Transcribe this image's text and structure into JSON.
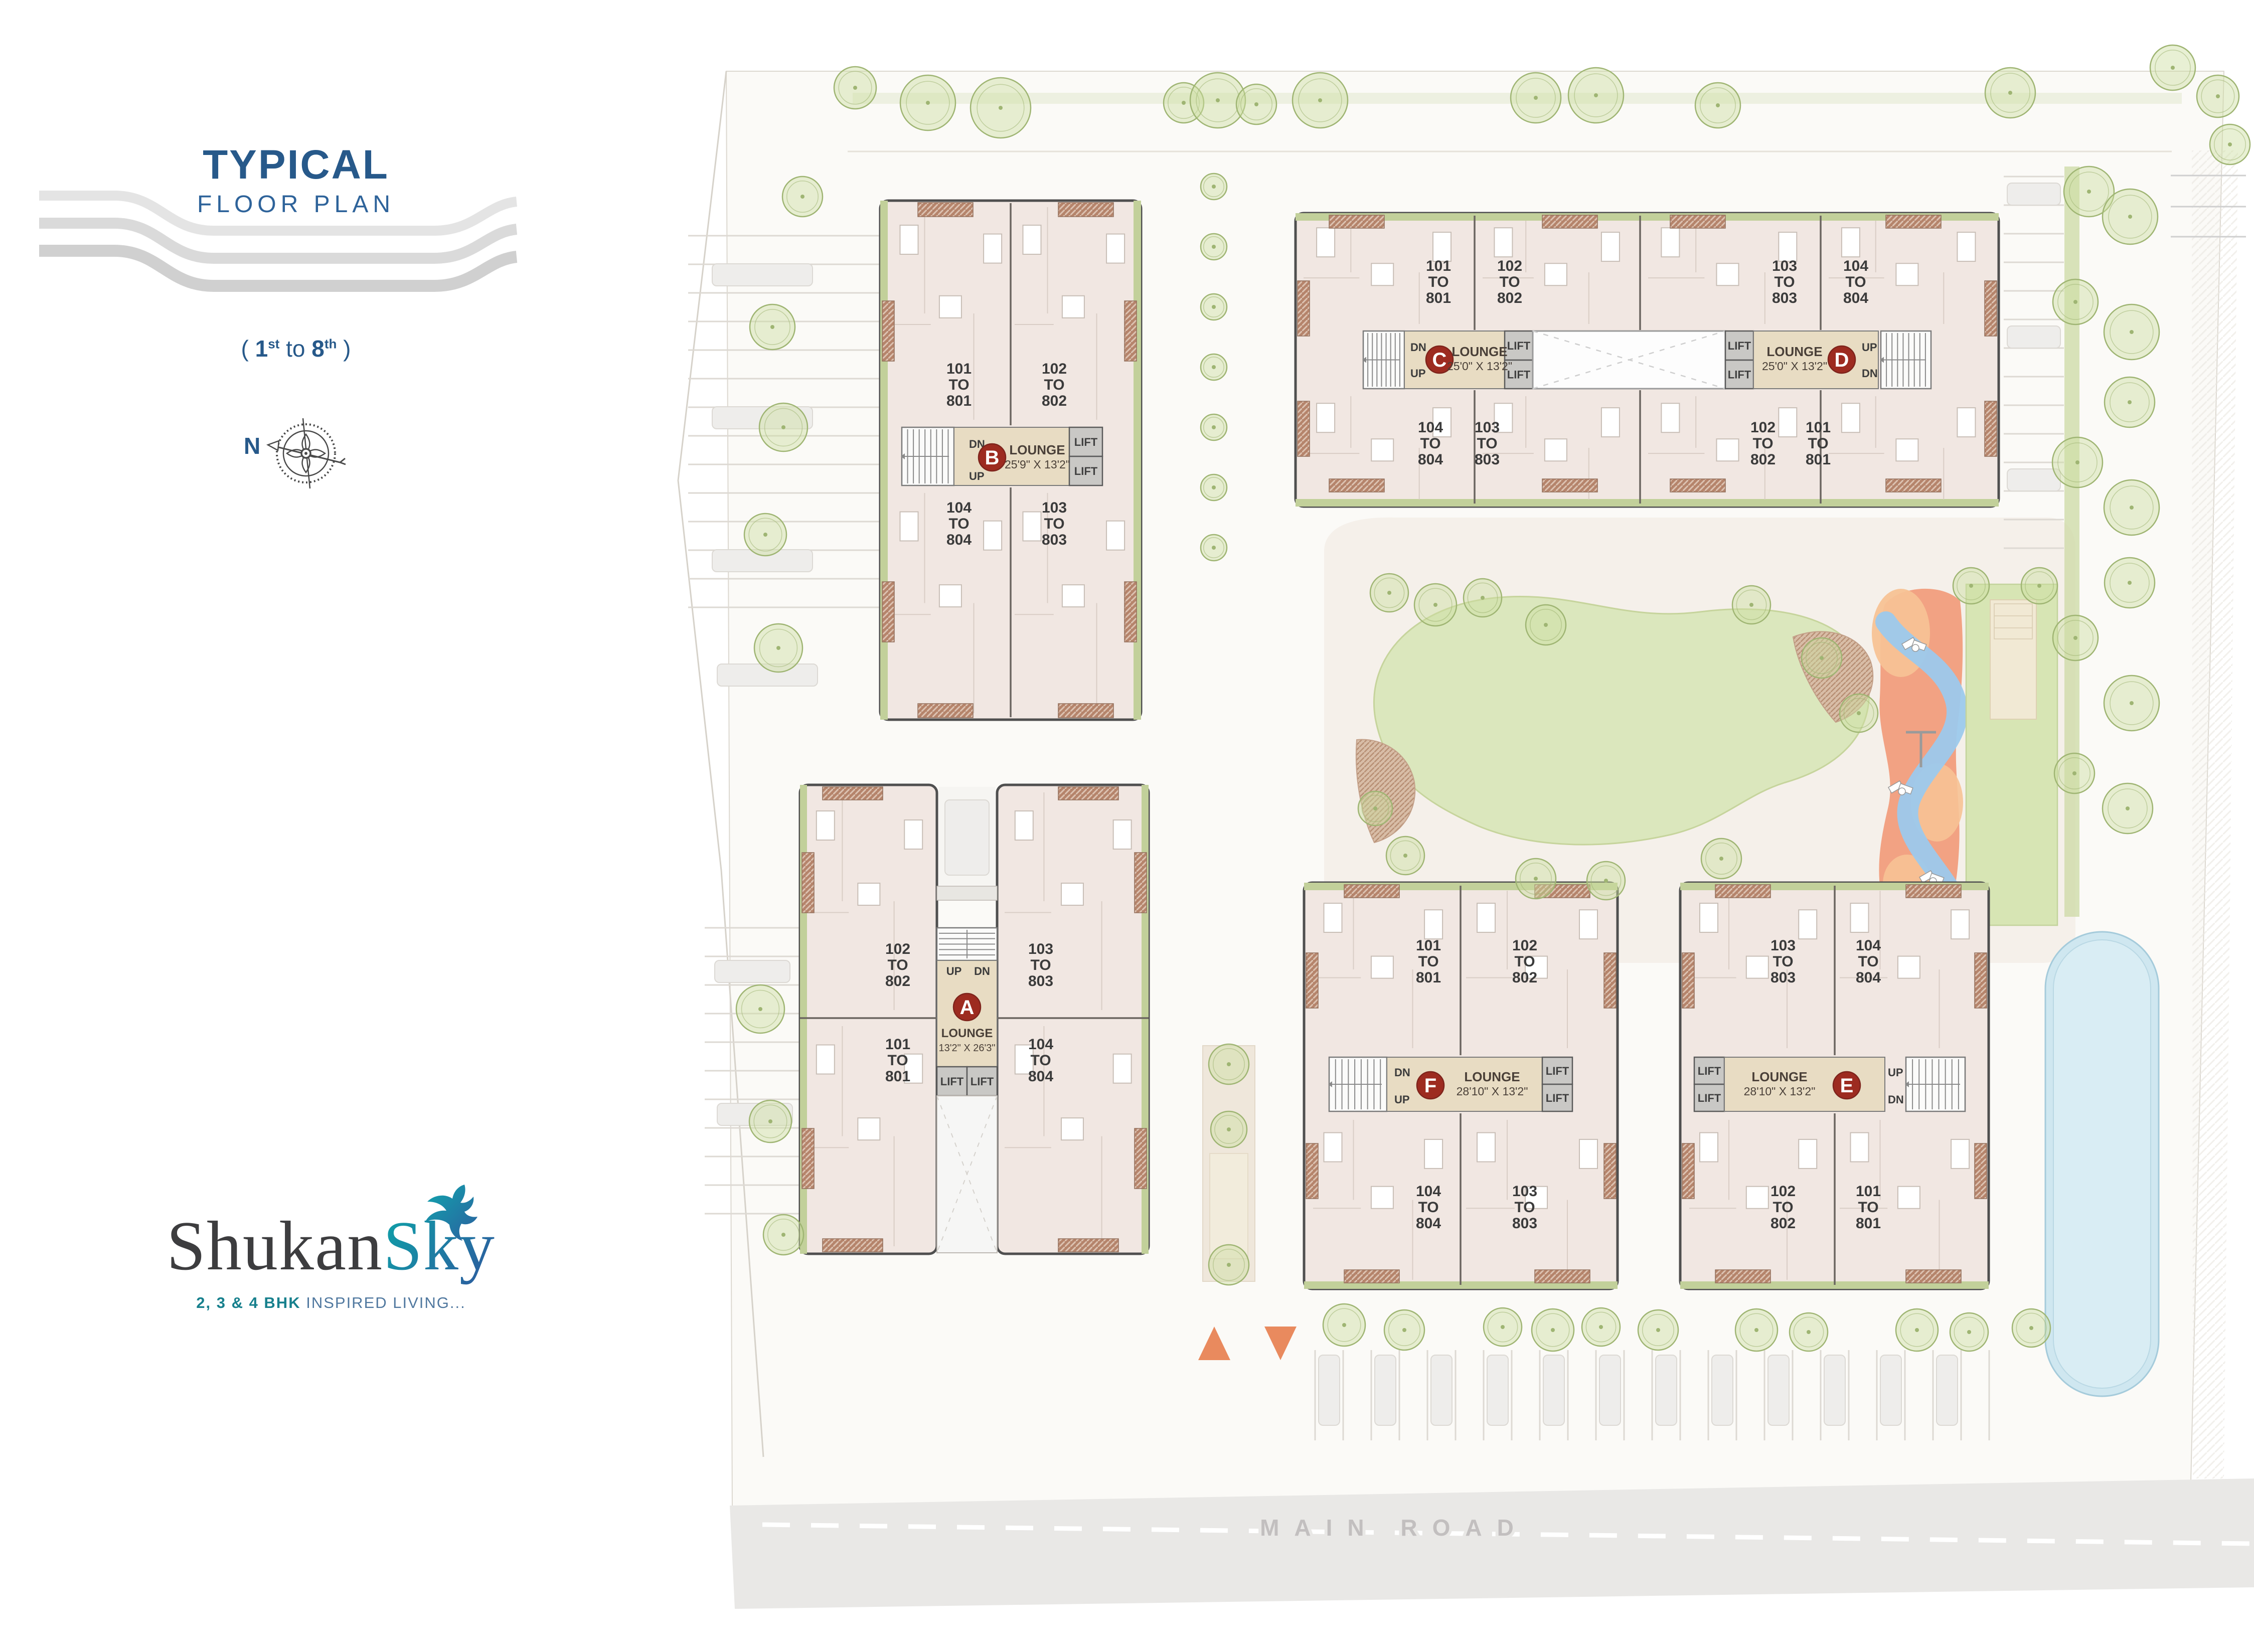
{
  "header": {
    "title": "TYPICAL",
    "subtitle": "FLOOR PLAN",
    "floor_range": {
      "prefix": "( ",
      "from": "1",
      "from_sup": "st",
      "mid": " to ",
      "to": "8",
      "to_sup": "th",
      "suffix": " )"
    },
    "north_label": "N"
  },
  "logo": {
    "brand_primary": "Shukan",
    "brand_secondary": "Sky",
    "tagline_bold": "2, 3 & 4 BHK",
    "tagline_rest": "INSPIRED LIVING..."
  },
  "road": {
    "label": "MAIN ROAD"
  },
  "core_labels": {
    "lift": "LIFT",
    "lounge": "LOUNGE",
    "up": "UP",
    "dn": "DN"
  },
  "buildings": [
    {
      "id": "A",
      "badge": "A",
      "lounge_size": "13'2\" X 26'3\"",
      "units": {
        "tl": [
          "102",
          "TO",
          "802"
        ],
        "tr": [
          "103",
          "TO",
          "803"
        ],
        "bl": [
          "101",
          "TO",
          "801"
        ],
        "br": [
          "104",
          "TO",
          "804"
        ]
      }
    },
    {
      "id": "B",
      "badge": "B",
      "lounge_size": "25'9\" X 13'2\"",
      "units": {
        "tl": [
          "101",
          "TO",
          "801"
        ],
        "tr": [
          "102",
          "TO",
          "802"
        ],
        "bl": [
          "104",
          "TO",
          "804"
        ],
        "br": [
          "103",
          "TO",
          "803"
        ]
      }
    },
    {
      "id": "C",
      "badge": "C",
      "lounge_size": "25'0\" X 13'2\"",
      "units": {
        "tl": [
          "101",
          "TO",
          "801"
        ],
        "tr": [
          "102",
          "TO",
          "802"
        ],
        "bl": [
          "104",
          "TO",
          "804"
        ],
        "br": [
          "103",
          "TO",
          "803"
        ]
      }
    },
    {
      "id": "D",
      "badge": "D",
      "lounge_size": "25'0\" X 13'2\"",
      "units": {
        "tl": [
          "103",
          "TO",
          "803"
        ],
        "tr": [
          "104",
          "TO",
          "804"
        ],
        "bl": [
          "102",
          "TO",
          "802"
        ],
        "br": [
          "101",
          "TO",
          "801"
        ]
      }
    },
    {
      "id": "E",
      "badge": "E",
      "lounge_size": "28'10\" X 13'2\"",
      "units": {
        "tl": [
          "103",
          "TO",
          "803"
        ],
        "tr": [
          "104",
          "TO",
          "804"
        ],
        "bl": [
          "102",
          "TO",
          "802"
        ],
        "br": [
          "101",
          "TO",
          "801"
        ]
      }
    },
    {
      "id": "F",
      "badge": "F",
      "lounge_size": "28'10\" X 13'2\"",
      "units": {
        "tl": [
          "101",
          "TO",
          "801"
        ],
        "tr": [
          "102",
          "TO",
          "802"
        ],
        "bl": [
          "104",
          "TO",
          "804"
        ],
        "br": [
          "103",
          "TO",
          "803"
        ]
      }
    }
  ],
  "colors": {
    "accent_blue": "#27598a",
    "badge_red": "#9d2b20",
    "wall": "#4f4f4f",
    "floor": "#f1e7e2",
    "lounge": "#e8dcc3",
    "lift": "#c9c8c5",
    "green_trim": "#c2d09a",
    "balcony": "#b5846b",
    "park": "#dbe7bd",
    "pool": "#cfe7f0",
    "playground": "#f2a283",
    "road": "#e9e8e6",
    "tree_line": "#9fb573",
    "label": "#3b3b3b"
  }
}
